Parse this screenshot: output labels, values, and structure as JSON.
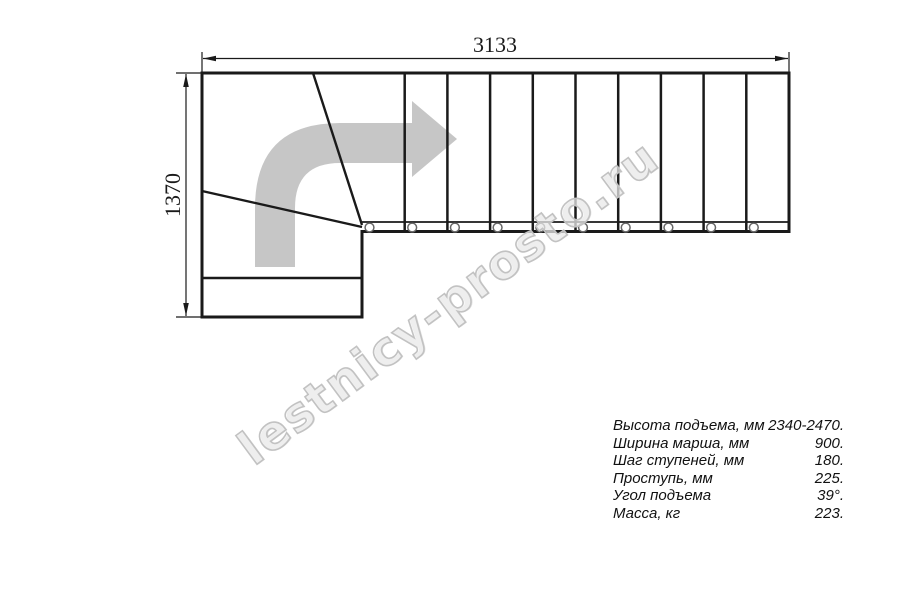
{
  "drawing": {
    "type": "staircase-plan-top-view",
    "description": "Quarter-turn (L-shaped) staircase plan with winder steps and direction-of-travel arrow",
    "straight_steps": 10,
    "winder_steps": 2,
    "bottom_landing_steps": 1,
    "bolt_circles": 10
  },
  "dimensions": {
    "width_label": "3133",
    "height_label": "1370"
  },
  "specs": {
    "rows": [
      {
        "label": "Высота подъема, мм",
        "value": "2340-2470."
      },
      {
        "label": "Ширина марша, мм",
        "value": "900."
      },
      {
        "label": "Шаг ступеней, мм",
        "value": "180."
      },
      {
        "label": "Проступь, мм",
        "value": "225."
      },
      {
        "label": "Угол подъема",
        "value": "39°."
      },
      {
        "label": "Масса, кг",
        "value": "223."
      }
    ]
  },
  "watermark": {
    "text": "lestnicy-prosto.ru"
  },
  "colors": {
    "background": "#ffffff",
    "line": "#1a1a1a",
    "arrow": "#c6c6c6",
    "bolt_stroke": "#666666",
    "watermark": "#c2c2c2"
  }
}
